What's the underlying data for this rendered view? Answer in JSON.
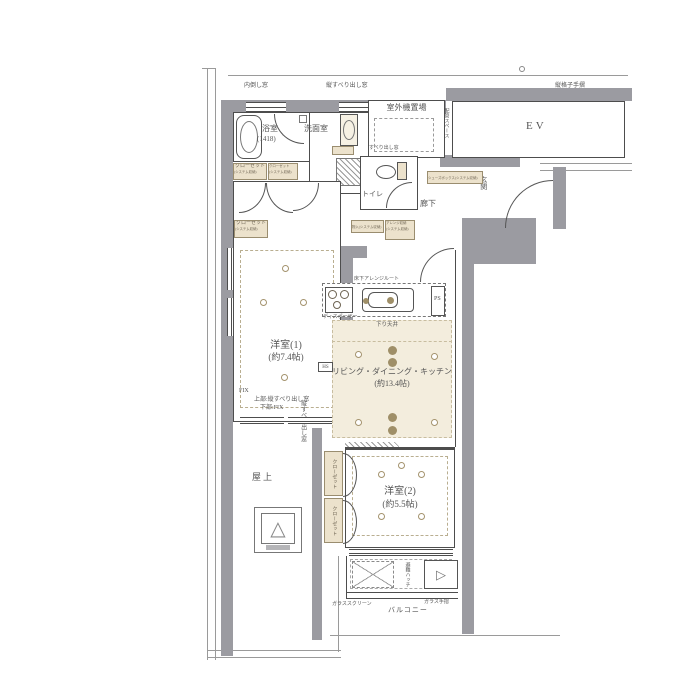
{
  "colors": {
    "wall": "#9b9ba1",
    "room_tint": "#f3eddd",
    "fixture_fill": "#ece2cc",
    "line": "#4d4d4d",
    "accent": "#a4936e"
  },
  "labels": {
    "tilt_window": "内倒し窓",
    "slide_window": "縦すべり出し窓",
    "lattice_handrail": "縦格子手摺",
    "outdoor_unit": "室外機置場",
    "piping_space": "配管スペース",
    "ev": "EV",
    "bathroom": "浴室",
    "bathroom_size": "(1418)",
    "washroom": "洗面室",
    "toilet": "トイレ",
    "hallway": "廊下",
    "entrance": "玄関",
    "shoes_box": "シューズボックス(システム収納)",
    "closet": "クローゼット",
    "system_storage": "(システム収納)",
    "storage": "物入(システム収納)",
    "arrange_storage": "アレンジ収納",
    "western1": "洋室(1)",
    "western1_size": "(約7.4帖)",
    "fix": "FIX",
    "upper_window": "上部:縦すべり出し窓",
    "lower_fix": "下部:FIX",
    "underfloor_route": "床下アレンジルート",
    "disposer": "ディスポーザー",
    "ps": "PS",
    "hs": "HS",
    "dropped_ceiling": "下り天井",
    "ldk": "リビング・ダイニング・キッチン",
    "ldk_size": "(約13.4帖)",
    "western2": "洋室(2)",
    "western2_size": "(約5.5帖)",
    "rooftop": "屋上",
    "escape_hatch": "避難ハッチ",
    "glass_screen": "ガラススクリーン",
    "glass_rail": "ガラス手摺",
    "balcony": "バルコニー"
  },
  "icons": {
    "skylight_triangle": "△",
    "hatch_triangle": "▷"
  }
}
